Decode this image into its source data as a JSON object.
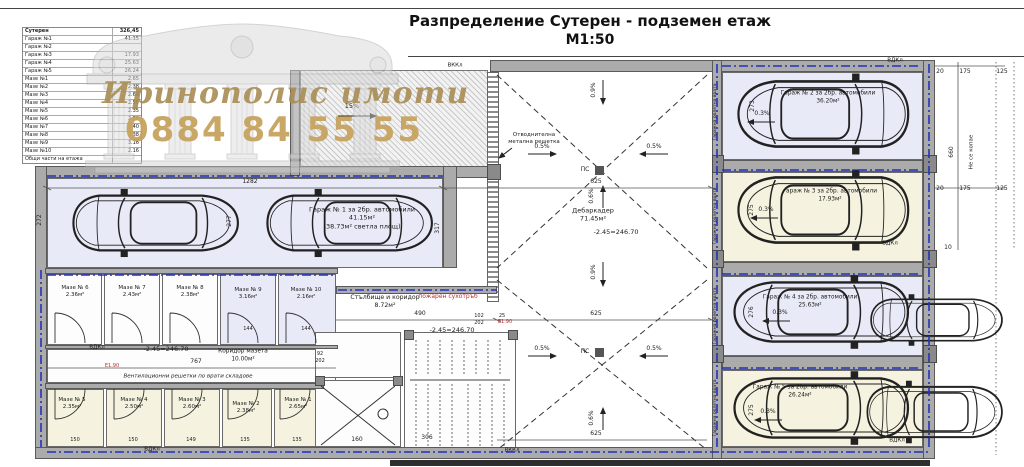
{
  "title": {
    "main": "Разпределение Сутерен - подземен етаж",
    "scale": "М1:50"
  },
  "watermark": {
    "brand": "Иринополис имоти",
    "phone": "0884 84 55 55"
  },
  "table": {
    "rows": [
      {
        "label": "Сутерен",
        "value": "326,45"
      },
      {
        "label": "Гараж №1",
        "value": "41.15"
      },
      {
        "label": "Гараж №2",
        "value": ""
      },
      {
        "label": "Гараж №3",
        "value": "17.93"
      },
      {
        "label": "Гараж №4",
        "value": "25.63"
      },
      {
        "label": "Гараж №5",
        "value": "26.24"
      },
      {
        "label": "Мазе №1",
        "value": "2.65"
      },
      {
        "label": "Мазе №2",
        "value": "2.38"
      },
      {
        "label": "Мазе №3",
        "value": "2.60"
      },
      {
        "label": "Мазе №4",
        "value": "2.50"
      },
      {
        "label": "Мазе №5",
        "value": "2.35"
      },
      {
        "label": "Мазе №6",
        "value": "2.36"
      },
      {
        "label": "Мазе №7",
        "value": "2.40"
      },
      {
        "label": "Мазе №8",
        "value": "2.38"
      },
      {
        "label": "Мазе №9",
        "value": "3.16"
      },
      {
        "label": "Мазе №10",
        "value": "2.16"
      },
      {
        "label": "Общи части на етажа",
        "value": ""
      }
    ]
  },
  "rooms": {
    "garage1": {
      "line1": "Гараж № 1 за 2бр. автомобили",
      "line2": "41.15м²",
      "line3": "(38.73м² светла площ)"
    },
    "garage2": {
      "line1": "Гараж № 2 за 2бр. автомобили",
      "line2": "36.20м²"
    },
    "garage3": {
      "line1": "гараж № 3 за 2бр. автомобили",
      "line2": "17.93м²"
    },
    "garage4": {
      "line1": "Гараж № 4 за 2бр. автомобили",
      "line2": "25.63м²"
    },
    "garage5": {
      "line1": "Гараж № 5 за 2бр. автомобили",
      "line2": "26.24м²"
    },
    "maze1": {
      "name": "Мазе № 1",
      "area": "2.65м²"
    },
    "maze2": {
      "name": "Мазе № 2",
      "area": "2.38м²"
    },
    "maze3": {
      "name": "Мазе № 3",
      "area": "2.60м²"
    },
    "maze4": {
      "name": "Мазе № 4",
      "area": "2.50м²"
    },
    "maze5": {
      "name": "Мазе № 5",
      "area": "2.35м²"
    },
    "maze6": {
      "name": "Мазе № 6",
      "area": "2.36м²"
    },
    "maze7": {
      "name": "Мазе № 7",
      "area": "2.43м²"
    },
    "maze8": {
      "name": "Мазе № 8",
      "area": "2.38м²"
    },
    "maze9": {
      "name": "Мазе № 9",
      "area": "3.16м²"
    },
    "maze10": {
      "name": "Мазе № 10",
      "area": "2.16м²"
    },
    "stairs": {
      "line1": "Стълбище и коридор",
      "line2": "8.72м²"
    },
    "corridor": {
      "line1": "Коридор мазета",
      "line2": "10.00м²"
    },
    "debarkader": {
      "line1": "Дебаркадер",
      "line2": "71.45м²"
    }
  },
  "annotations": {
    "vdkl": "ВДКл",
    "vkkl": "ВККл",
    "ps": "ПС",
    "no_dig": "Не се копае",
    "roller_door": "Гаражна ролетна врата",
    "drain_l1": "Отводнителна",
    "drain_l2": "метална решетка",
    "vent_note": "Вентилационни решетки по врати складове",
    "fire_pipe": "пожарен сухотръб",
    "level": "-2.45=246.70",
    "e_mark": "Е1.90",
    "slope05": "0.5%",
    "slope09": "0.9%",
    "slope06": "0.6%",
    "slope03": "0.3%",
    "ramp_slope": "15%"
  },
  "dims": {
    "d1282": "1282",
    "d625": "625",
    "d490": "490",
    "d767": "767",
    "d306": "306",
    "d160": "160",
    "d272": "272",
    "d277": "277",
    "d317": "317",
    "d273": "273",
    "d275": "275",
    "d276": "276",
    "d150": "150",
    "d149": "149",
    "d135": "135",
    "d144": "144",
    "d20": "20",
    "d175": "175",
    "d125": "125",
    "d10": "10",
    "d660": "660",
    "d102": "102",
    "d202": "202",
    "d25": "25",
    "d92": "92"
  }
}
